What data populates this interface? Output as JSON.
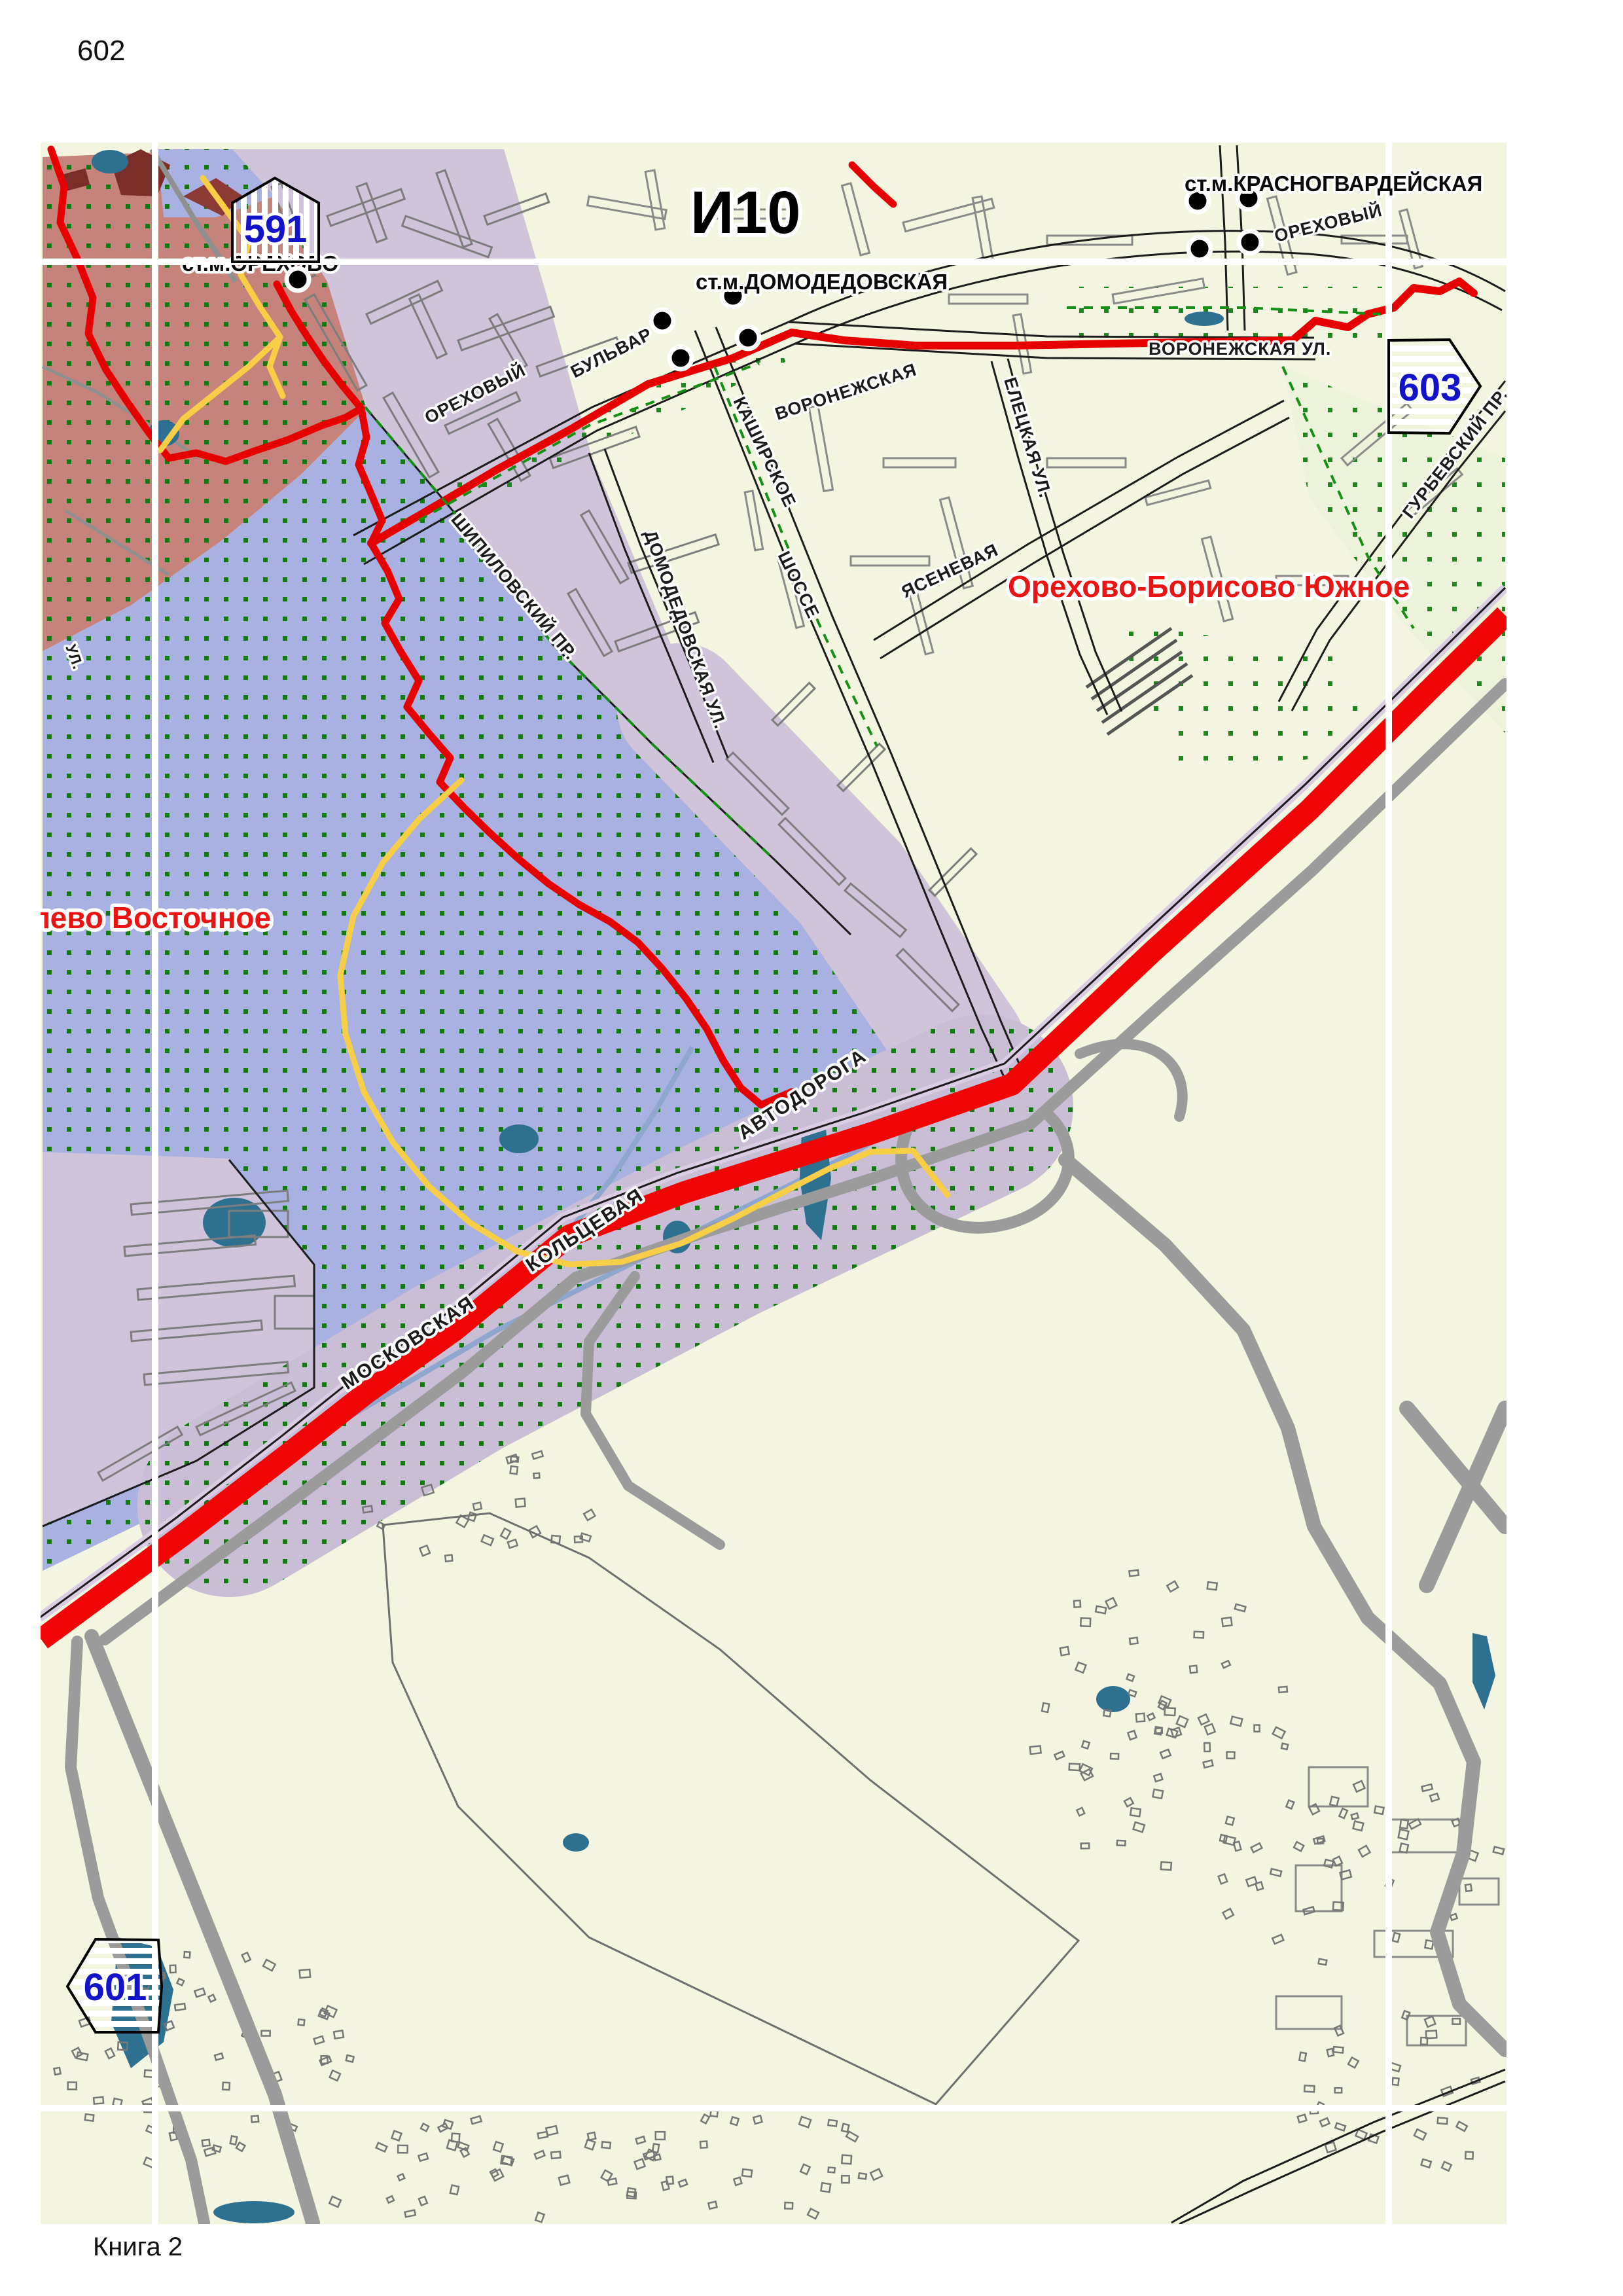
{
  "page": {
    "number": "602",
    "book_label": "Книга 2",
    "sheet_code": "И10"
  },
  "badges": {
    "top_left": "591",
    "right": "603",
    "bottom_left": "601"
  },
  "metro_stations": {
    "orekhovo": "ст.м.ОРЕХОВО",
    "domodedovskaya": "ст.м.ДОМОДЕДОВСКАЯ",
    "krasnogvardeyskaya": "ст.м.КРАСНОГВАРДЕЙСКАЯ"
  },
  "district_labels": {
    "orekhovo_borisovo_yuzhnoe": "Орехово-Борисово Южное",
    "vostochnoe_partial": "лево Восточное"
  },
  "street_labels": {
    "orekhovy": "ОРЕХОВЫЙ",
    "bulvar": "БУЛЬВАР",
    "voronezhskaya": "ВОРОНЕЖСКАЯ",
    "voronezhskaya_ul": "ВОРОНЕЖСКАЯ УЛ.",
    "kashirskoe": "КАШИРСКОЕ",
    "shosse": "ШОССЕ",
    "shipilovsky_pr": "ШИПИЛОВСКИЙ ПР.",
    "domodedovskaya_ul": "ДОМОДЕДОВСКАЯ УЛ.",
    "eletskaya_ul": "ЕЛЕЦКАЯ УЛ.",
    "yasenevaya": "ЯСЕНЕВАЯ",
    "orekhovy_ne": "ОРЕХОВЫЙ",
    "gurievsky_pr": "ГУРЬЕВСКИЙ ПР.",
    "ul_small": "УЛ.",
    "mkad_moskovskaya": "МОСКОВСКАЯ",
    "mkad_koltsevaya": "КОЛЬЦЕВАЯ",
    "mkad_avtodoroga": "АВТОДОРОГА"
  },
  "colors": {
    "page_background": "#FFFFFF",
    "map_background": "#F3F5E1",
    "parkland_salmon": "#C5837B",
    "parkland_blue": "#A9B1E2",
    "residential_purple": "#CFC4DA",
    "residential_purple_dotted": "#C9BED6",
    "park_green_tint": "#EDF3DA",
    "green_dot": "#157815",
    "water": "#2E7090",
    "mkad_red": "#F00404",
    "route_red": "#E60000",
    "path_yellow": "#F7CE46",
    "road_gray": "#9B9B9B",
    "road_black": "#1C1C1C",
    "district_red": "#EC1313",
    "badge_blue": "#1313CB",
    "grid_white": "#FFFFFF"
  }
}
